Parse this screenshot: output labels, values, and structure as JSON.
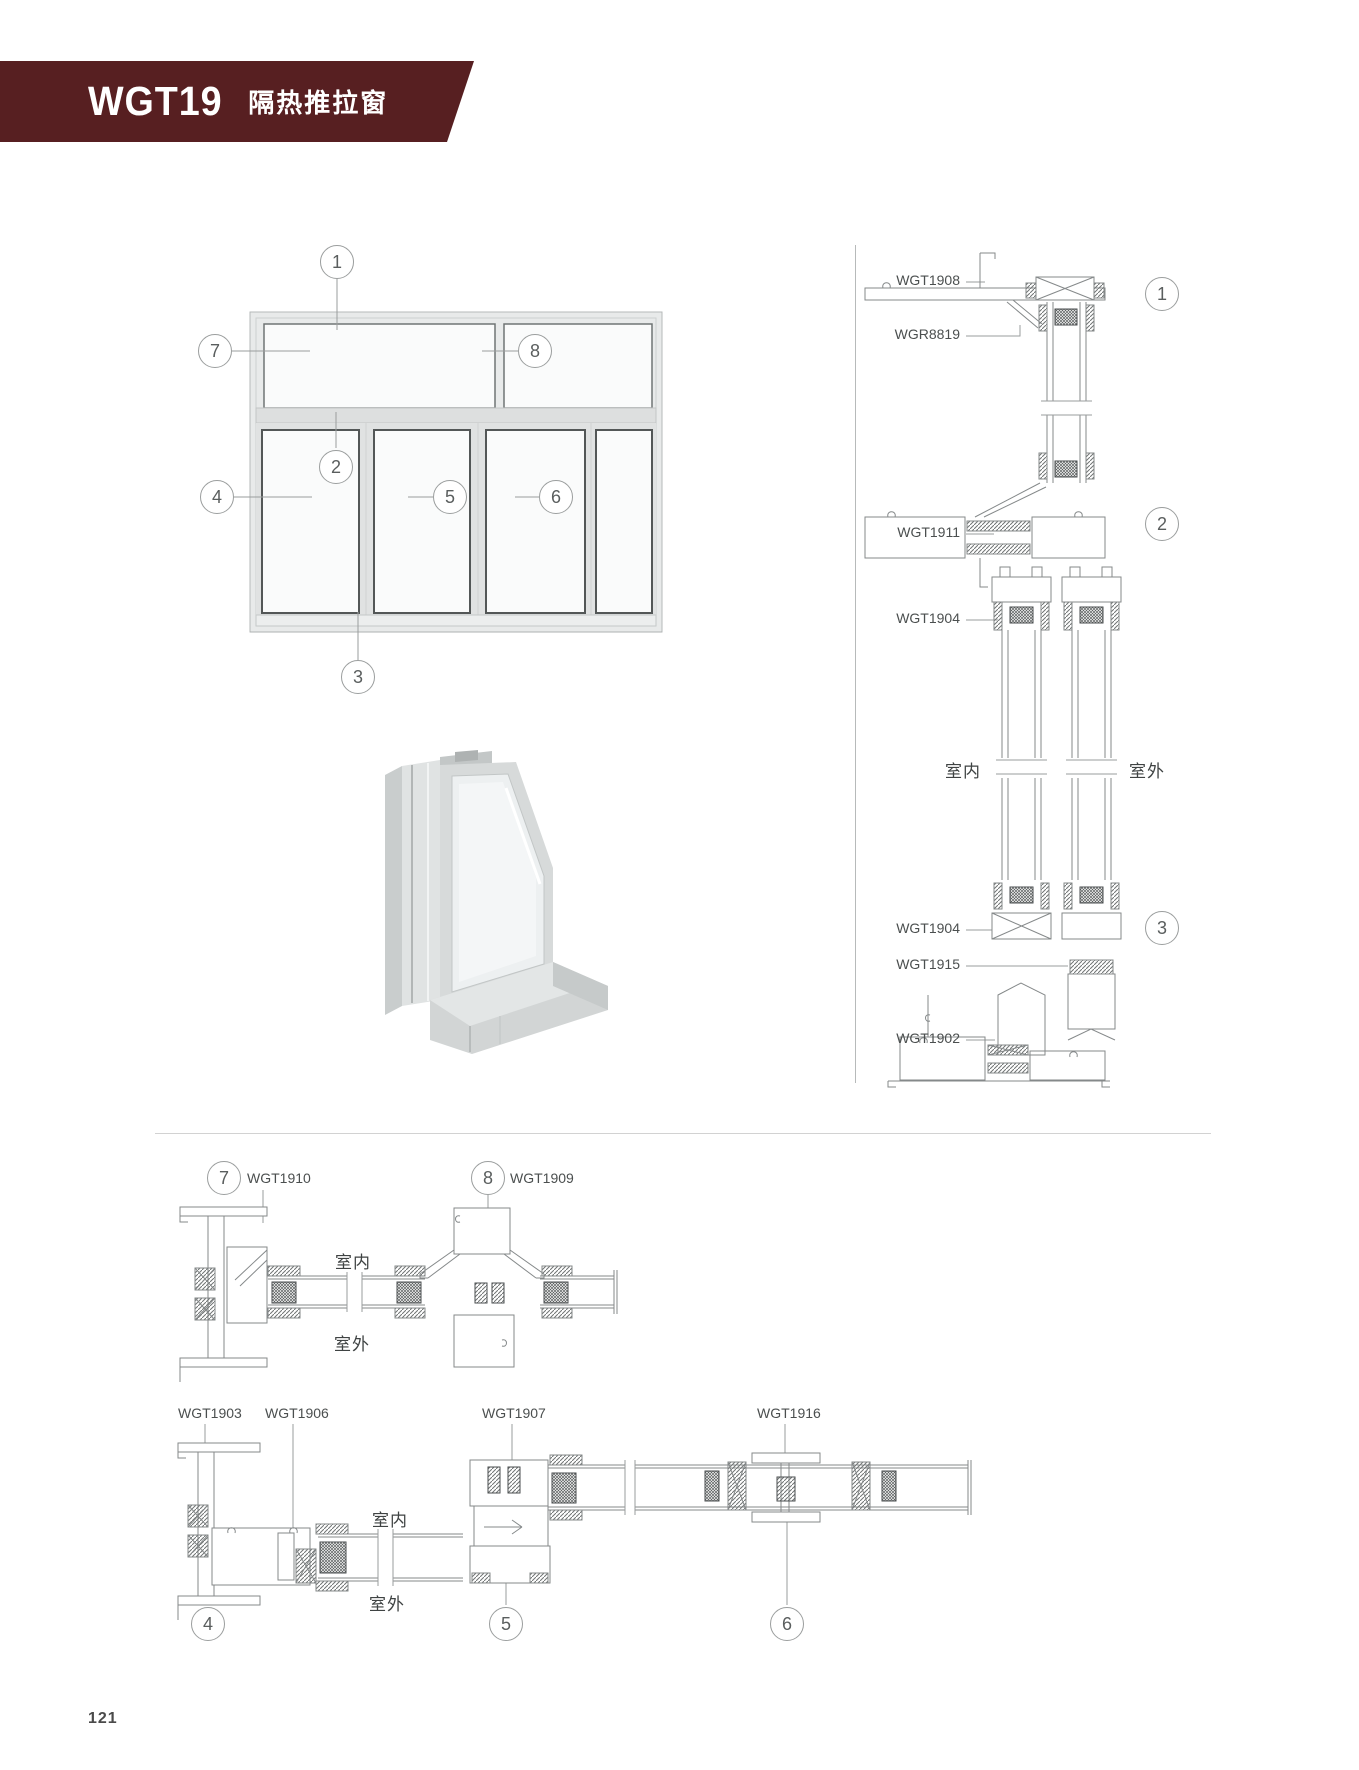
{
  "header": {
    "model": "WGT19",
    "series_name": "隔热推拉窗",
    "band_color": "#571f21"
  },
  "labels": {
    "indoor": "室内",
    "outdoor": "室外"
  },
  "elevation": {
    "callouts": [
      "1",
      "2",
      "3",
      "4",
      "5",
      "6",
      "7",
      "8"
    ]
  },
  "vertical_section": {
    "callouts": [
      "1",
      "2",
      "3"
    ],
    "profile_labels": {
      "top_frame": "WGT1908",
      "adapter": "WGR8819",
      "transom": "WGT1911",
      "sash_rail_mid": "WGT1904",
      "sash_rail_bottom": "WGT1904",
      "roller": "WGT1915",
      "bottom_frame": "WGT1902"
    }
  },
  "section_top": {
    "callouts": [
      "7",
      "8"
    ],
    "profile_labels": {
      "side_frame": "WGT1910",
      "mullion": "WGT1909"
    }
  },
  "section_bottom": {
    "callouts": [
      "4",
      "5",
      "6"
    ],
    "profile_labels": {
      "side_frame": "WGT1903",
      "sash_stile": "WGT1906",
      "interlock": "WGT1907",
      "meeting_stile": "WGT1916"
    }
  },
  "footer": {
    "page_number": "121"
  }
}
